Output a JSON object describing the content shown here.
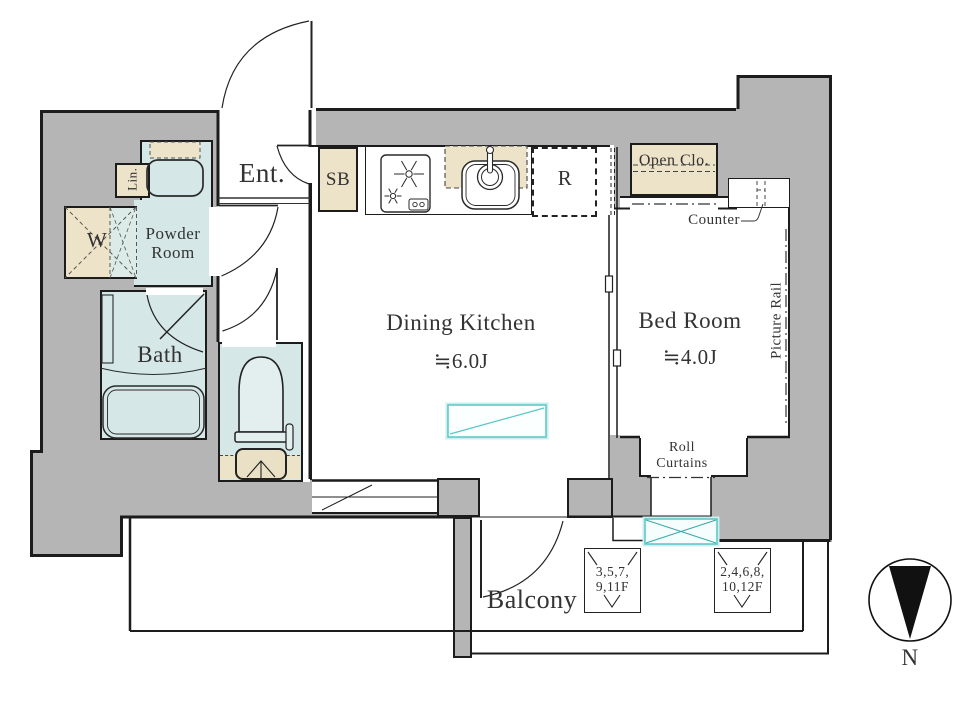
{
  "colors": {
    "wall_gray": "#b5b5b5",
    "wet_area_blue": "#d5e7e7",
    "storage_beige": "#ece3c8",
    "line_black": "#1c1c1c",
    "accent_cyan": "#57c7c7",
    "label_text": "#333333"
  },
  "rooms": {
    "entrance": "Ent.",
    "shoe_box": "SB",
    "refrigerator": "R",
    "open_closet": "Open Clo.",
    "counter": "Counter",
    "picture_rail": "Picture Rail",
    "powder_room": "Powder Room",
    "linen": "Lin.",
    "washer": "W",
    "bath": "Bath",
    "dining_kitchen": "Dining Kitchen",
    "dining_kitchen_size": "≒6.0J",
    "bed_room": "Bed Room",
    "bed_room_size": "≒4.0J"
  },
  "balcony": {
    "label": "Balcony",
    "roll_curtains": "Roll Curtains",
    "hatch_odd_floors": "3,5,7, 9,11F",
    "hatch_even_floors": "2,4,6,8, 10,12F"
  },
  "compass": {
    "north": "N"
  }
}
